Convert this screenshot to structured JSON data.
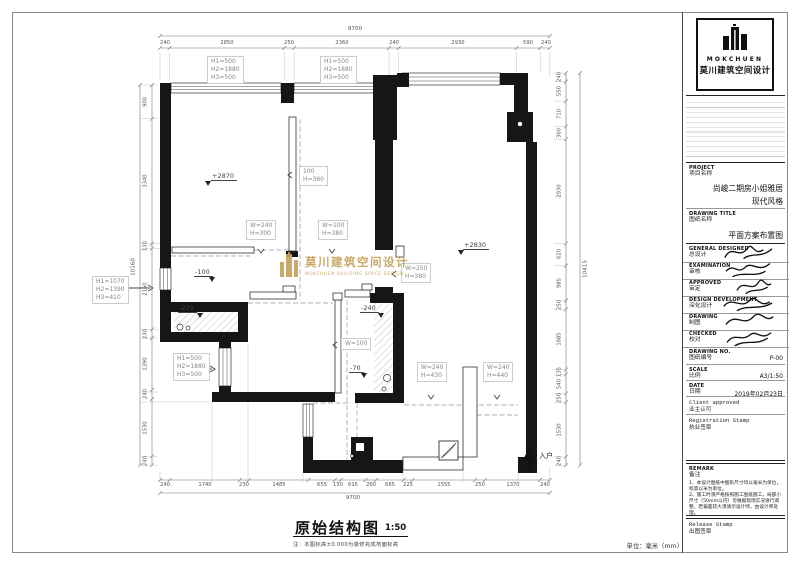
{
  "sheet": {
    "unit_note": "单位：毫米（mm）"
  },
  "plan": {
    "title": "原始结构图",
    "scale": "1:50",
    "note": "注：本图标高±0.000为装修完成地面标高",
    "entry": "入户",
    "watermark": {
      "cn": "莫川建筑空间设计",
      "en": "MOKCHUEN BUILDING SPACE DESIGN",
      "color": "#c8a45f"
    },
    "elevations": {
      "e1": "+2870",
      "e2": "+2830",
      "e3": "-100",
      "e4": "-220",
      "e5": "-240",
      "e6": "-70"
    },
    "window_labels": {
      "w1": {
        "l1": "H1=500",
        "l2": "H2=1880",
        "l3": "H3=500"
      },
      "w2": {
        "l1": "H1=500",
        "l2": "H2=1880",
        "l3": "H3=500"
      },
      "w3": {
        "l1": "H1=1070",
        "l2": "H2=1390",
        "l3": "H3=410"
      },
      "w4": {
        "l1": "H1=500",
        "l2": "H2=1880",
        "l3": "H3=500"
      }
    },
    "openings": {
      "o1": {
        "l1": "100",
        "l2": "H=360"
      },
      "o2": {
        "l1": "W=240",
        "l2": "H=300"
      },
      "o3": {
        "l1": "W=100",
        "l2": "H=380"
      },
      "o4": {
        "l1": "W=250",
        "l2": "H=380"
      },
      "o5": {
        "l1": "W=100"
      },
      "o6": {
        "l1": "W=240",
        "l2": "H=430"
      },
      "o7": {
        "l1": "W=240",
        "l2": "H=440"
      }
    }
  },
  "dims": {
    "top": {
      "total": "9700",
      "values": [
        "240",
        "2850",
        "250",
        "2360",
        "240",
        "2930",
        "590",
        "240"
      ]
    },
    "bottom": {
      "total": "9700",
      "values": [
        "240",
        "1740",
        "230",
        "1485",
        "655",
        "150",
        "615",
        "260",
        "685",
        "225",
        "1555",
        "250",
        "1370",
        "240"
      ]
    },
    "left": {
      "total": "10160",
      "values": [
        "900",
        "3340",
        "130",
        "2160",
        "230",
        "1390",
        "240",
        "1530",
        "240"
      ]
    },
    "right": {
      "total": "10415",
      "values": [
        "240",
        "550",
        "710",
        "360",
        "2930",
        "620",
        "985",
        "250",
        "1685",
        "135",
        "540",
        "250",
        "1530",
        "240"
      ]
    }
  },
  "titleblock": {
    "logo": {
      "en": "MOKCHUEN",
      "cn": "莫川建筑空间设计"
    },
    "project": {
      "en": "PROJECT",
      "cn": "项目名称",
      "value1": "尚峻二期房小姐雅居",
      "value2": "现代风格"
    },
    "drawing_title": {
      "en": "DRAWING TITLE",
      "cn": "图纸名称",
      "value": "平面方案布置图"
    },
    "sign_rows": [
      {
        "en": "GENERAL DESIGNED",
        "cn": "总设计"
      },
      {
        "en": "EXAMINATION",
        "cn": "审核"
      },
      {
        "en": "APPROVED",
        "cn": "审定"
      },
      {
        "en": "DESIGN DEVELOPMENT",
        "cn": "深化设计"
      },
      {
        "en": "DRAWING",
        "cn": "制图"
      },
      {
        "en": "CHECKED",
        "cn": "校对"
      }
    ],
    "drawing_no": {
      "en": "DRAWING NO.",
      "cn": "图纸编号",
      "value": "P-00"
    },
    "scale": {
      "en": "SCALE",
      "cn": "比例",
      "value": "A3/1:50"
    },
    "date": {
      "en": "DATE",
      "cn": "日期",
      "value": "2019年02月23日"
    },
    "client": {
      "en": "Client approved",
      "cn": "业主认可"
    },
    "registration": {
      "en": "Registration Stamp",
      "cn": "执业签章"
    },
    "remark": {
      "en": "REMARK",
      "cn": "备注",
      "note1": "1、本设计图纸中图形尺寸均以毫米为单位，标高以米为单位。",
      "note2": "2、施工时须严格按照施工图纸施工，局部小尺寸（50mm以内）可根据现场实况进行调整，若偏差较大须请示设计师，由设计师处理。"
    },
    "release": {
      "en": "Release Stamp",
      "cn": "出图签章"
    }
  }
}
